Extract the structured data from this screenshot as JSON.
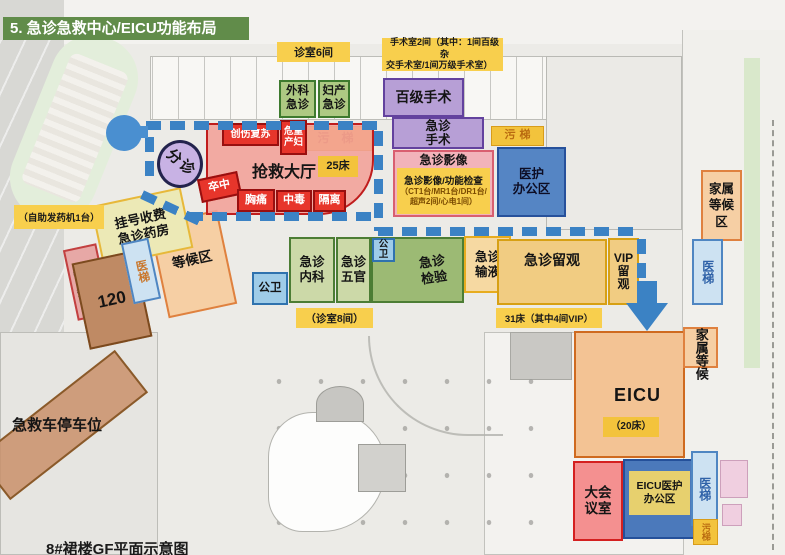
{
  "title": "5. 急诊急救中心/EICU功能布局",
  "caption": "8#裙楼GF平面示意图",
  "colors": {
    "title_bg": "#618c4a",
    "route_blue": "#3b82c4",
    "note_yellow": "#f8cf4d",
    "rescue_red": "#e7352b",
    "surgery_purple": "#b79fd6",
    "office_blue": "#5585c4",
    "eicu_orange": "#f3c394"
  },
  "labels": {
    "consult6": "诊室6间",
    "or2_l1": "手术室2间（其中：1间百级杂",
    "or2_l2": "交手术室/1间万级手术室）",
    "surg_emerg": "外科急诊",
    "obgyn_emerg": "妇产急诊",
    "or100": "百级手术",
    "emerg_or": "急诊手术",
    "dirty_elev": "污梯",
    "med_elev": "医梯",
    "pub_toilet": "公卫",
    "trauma": "创伤复苏",
    "crit_maternal": "危重产妇",
    "rescue_hall": "抢救大厅",
    "beds25": "25床",
    "stroke": "卒中",
    "chest_pain": "胸痛",
    "poison": "中毒",
    "isolation": "隔离",
    "triage": "分诊",
    "imaging_title": "急诊影像",
    "imaging_l1": "急诊影像/功能检查",
    "imaging_l2": "（CT1台/MR1台/DR1台/",
    "imaging_l3": "超声2间/心电1间）",
    "staff_office_l1": "医护",
    "staff_office_l2": "办公区",
    "family_wait_area": "家属等候区",
    "dispenser": "（自助发药机1台）",
    "register_l1": "挂号收费",
    "register_l2": "急诊药房",
    "wait_area": "等候区",
    "pretreat_l1": "中毒病人",
    "pretreat_l2": "预处理",
    "amb120": "120",
    "internal": "急诊内科",
    "ent": "急诊五官",
    "lab": "急诊检验",
    "infusion": "急诊输液",
    "obs": "急诊留观",
    "vip_l1": "VIP",
    "vip_l2": "留",
    "vip_l3": "观",
    "consult8": "（诊室8间）",
    "beds31": "31床（其中4间VIP）",
    "amb_parking": "急救车停车位",
    "eicu": "EICU",
    "beds20": "（20床）",
    "family_wait2": "家属等候",
    "conference": "大会议室",
    "eicu_office_l1": "EICU医护",
    "eicu_office_l2": "办公区"
  }
}
